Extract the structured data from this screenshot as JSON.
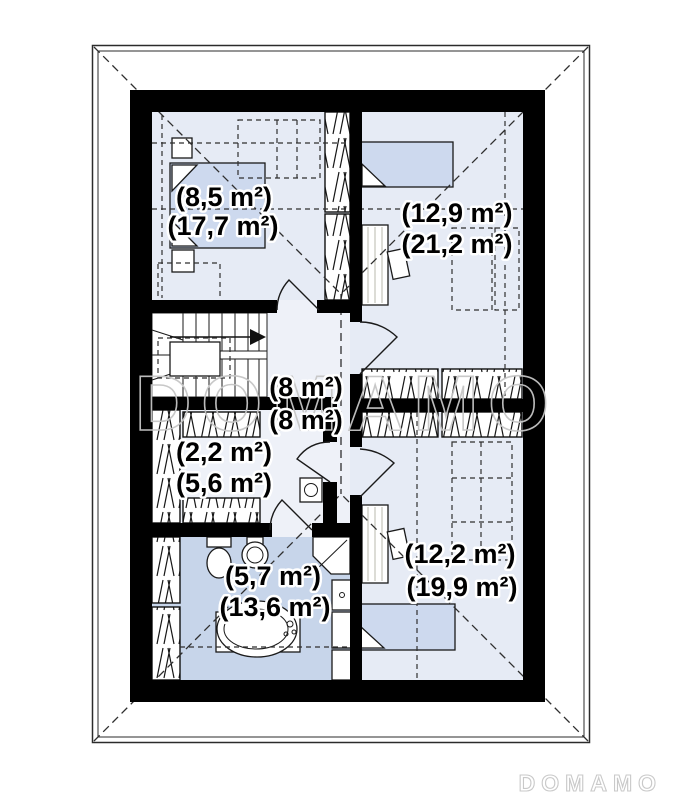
{
  "watermark": {
    "text": "DOMAMO"
  },
  "brand": {
    "logo_text": "DOMAMO"
  },
  "plan": {
    "rooms": [
      {
        "id": "bedroom-top-left",
        "net_area": "(8,5 m²)",
        "gross_area": "(17,7 m²)"
      },
      {
        "id": "bedroom-top-right",
        "net_area": "(12,9 m²)",
        "gross_area": "(21,2 m²)"
      },
      {
        "id": "hallway",
        "net_area": "(8 m²)",
        "gross_area": "(8 m²)"
      },
      {
        "id": "wardrobe-room",
        "net_area": "(2,2 m²)",
        "gross_area": "(5,6 m²)"
      },
      {
        "id": "bathroom",
        "net_area": "(5,7 m²)",
        "gross_area": "(13,6 m²)"
      },
      {
        "id": "bedroom-bottom-right",
        "net_area": "(12,2 m²)",
        "gross_area": "(19,9 m²)"
      }
    ],
    "colors": {
      "wall": "#000000",
      "room_floor": "#e6ebf5",
      "hall_floor": "#eef1f8",
      "bathroom_floor": "#c7d5ea",
      "furniture_blue": "#cdd9ee",
      "watermark_gray": "#c6c6c6",
      "logo_gray": "#c9c9c9"
    }
  }
}
